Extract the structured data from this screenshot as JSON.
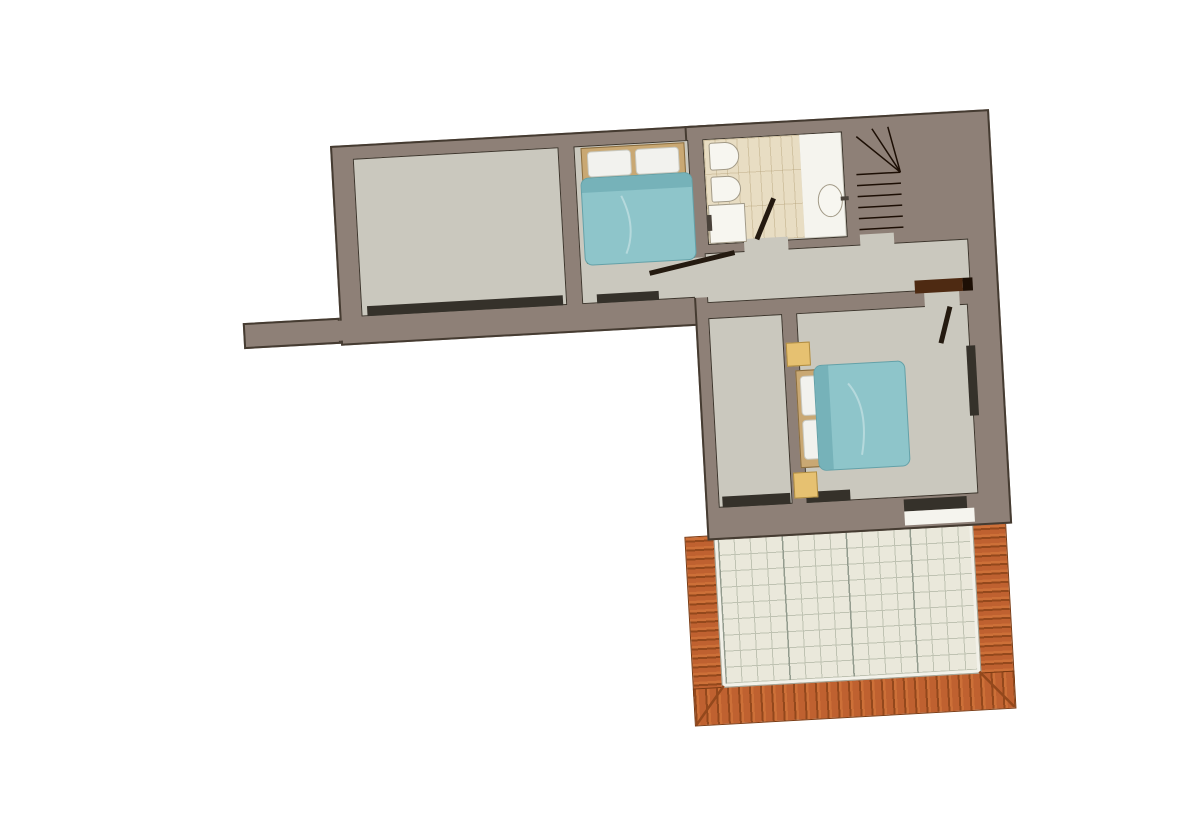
{
  "palette": {
    "bg": "#ffffff",
    "wall": "#8e8077",
    "wall_line": "#453b31",
    "floor": "#cac8be",
    "floor_line": "#3d352c",
    "window_strip": "#35312a",
    "tile_beige": "#e8ddc3",
    "tile_line": "#d2c4a3",
    "white": "#f5f4ee",
    "stairs": "#3d2313",
    "stairs_dark": "#2f1b0c",
    "void": "#0b0502",
    "tread": "#1c0e04",
    "railing": "#d6d1c8",
    "bed_frame": "#c9a873",
    "bed_frame_line": "#8a6d3f",
    "duvet": "#8ec5ca",
    "duvet_roll": "#76b2b9",
    "duvet_line": "#64a1a8",
    "pillow": "#f2f2ee",
    "pillow_line": "#c9c9c0",
    "nightstand": "#e6c171",
    "lintel": "#4e2a12",
    "terracotta": "#bf6130",
    "terracotta_light": "#cd7038",
    "terracotta_dark": "#93481c",
    "terrace_tile": "#eae8db",
    "terrace_line": "#bfc2b2",
    "terrace_accent": "#939b8e",
    "terrace_edge": "#f2f1e9"
  },
  "plan": {
    "rotation_deg": -3.2,
    "rooms": {
      "living": {
        "name": "large empty room"
      },
      "bedroom1": {
        "name": "bedroom with double bed, top"
      },
      "bathroom": {
        "name": "tiled bathroom with toilet, bidet, shower and washbasin"
      },
      "stairs": {
        "name": "winding staircase"
      },
      "hallway": {
        "name": "hallway"
      },
      "closet": {
        "name": "narrow room"
      },
      "bedroom2": {
        "name": "bedroom with double bed and nightstands, right"
      },
      "terrace": {
        "name": "tiled terrace with terracotta roof edge"
      }
    },
    "furniture": {
      "bed1": {
        "name": "double bed, teal duvet, two pillows"
      },
      "bed2": {
        "name": "double bed, teal duvet, two pillows"
      },
      "toilet": {
        "name": "toilet"
      },
      "bidet": {
        "name": "bidet"
      },
      "shower": {
        "name": "shower tray"
      },
      "basin": {
        "name": "washbasin"
      },
      "nightstand1": {
        "name": "nightstand"
      },
      "nightstand2": {
        "name": "nightstand"
      }
    }
  }
}
